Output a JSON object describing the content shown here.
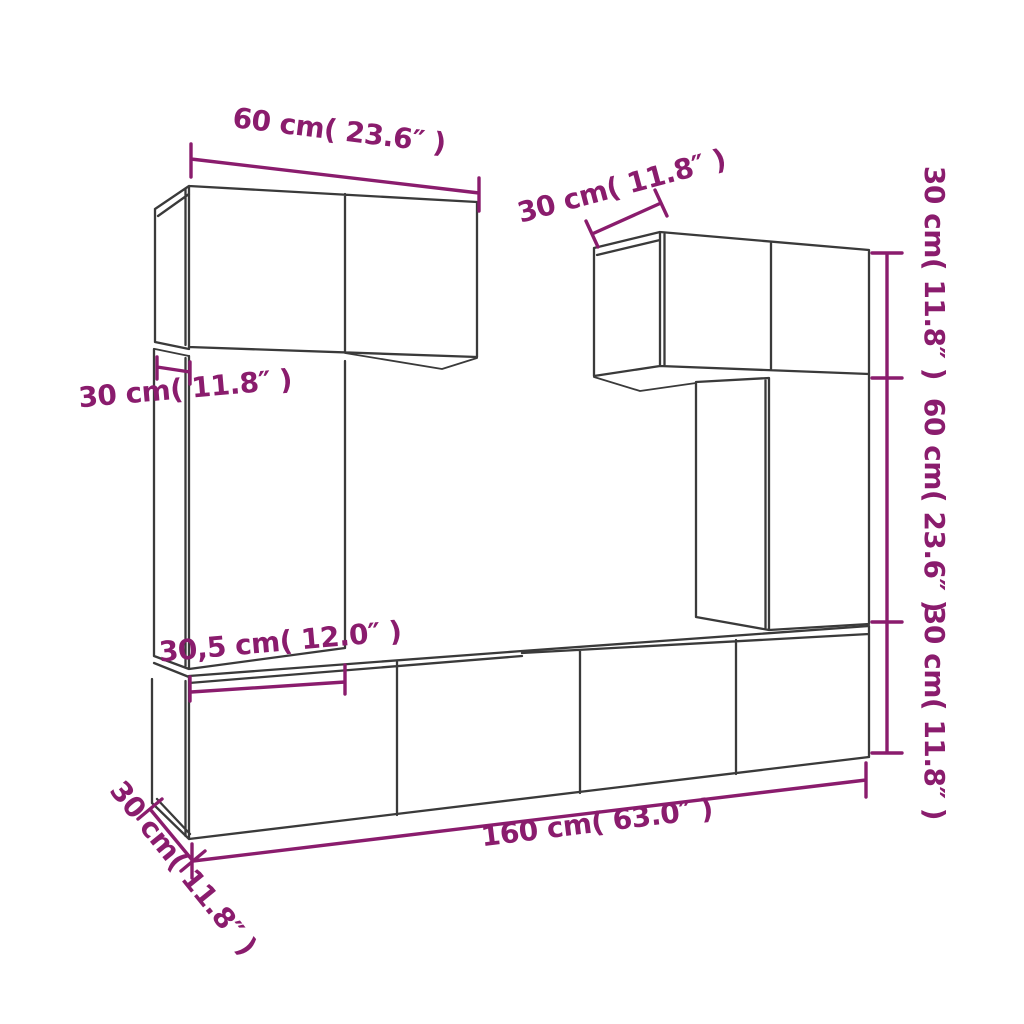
{
  "diagram": {
    "type": "furniture-dimension-diagram",
    "subject": "wall-mounted TV cabinet set (6 units) with dimension annotations",
    "colors": {
      "outline": "#3a3a3a",
      "dimension": "#8a1c6d",
      "background": "#ffffff"
    },
    "labels": {
      "top_left_width": "60 cm( 23.6″ )",
      "left_depth": "30 cm( 11.8″ )",
      "tall_cabinet_width": "30,5 cm( 12.0″ )",
      "top_right_depth": "30 cm( 11.8″ )",
      "right_top_height": "30 cm( 11.8″ )",
      "right_middle_height": "60 cm( 23.6″ )",
      "right_bottom_height": "30 cm( 11.8″ )",
      "bottom_width": "160 cm( 63.0″ )",
      "bottom_left_depth": "30 cm( 11.8″ )"
    },
    "measurements": [
      {
        "part": "top-left wall cabinet width",
        "cm": "60",
        "inch": "23.6"
      },
      {
        "part": "left cabinet depth",
        "cm": "30",
        "inch": "11.8"
      },
      {
        "part": "tall left cabinet width",
        "cm": "30,5",
        "inch": "12.0"
      },
      {
        "part": "top-right cabinet depth",
        "cm": "30",
        "inch": "11.8"
      },
      {
        "part": "top-right cabinet height",
        "cm": "30",
        "inch": "11.8"
      },
      {
        "part": "right column cabinet height",
        "cm": "60",
        "inch": "23.6"
      },
      {
        "part": "bottom row height",
        "cm": "30",
        "inch": "11.8"
      },
      {
        "part": "bottom row width",
        "cm": "160",
        "inch": "63.0"
      },
      {
        "part": "bottom row depth",
        "cm": "30",
        "inch": "11.8"
      }
    ]
  }
}
